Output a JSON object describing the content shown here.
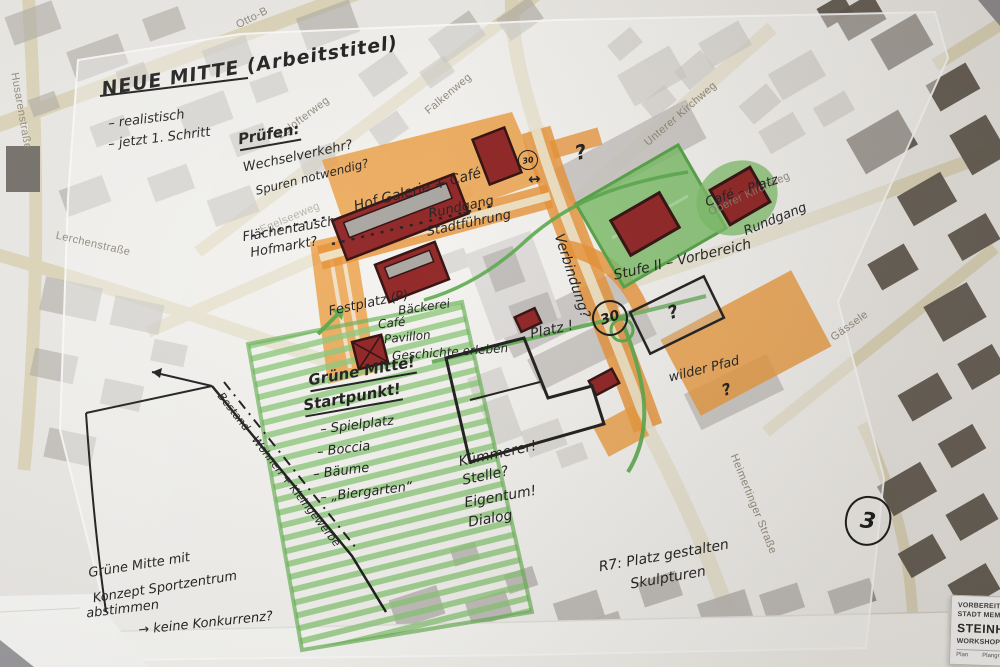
{
  "streets": [
    {
      "name": "Husarenstraße"
    },
    {
      "name": "Otto-B"
    },
    {
      "name": "Falkenweg"
    },
    {
      "name": "Eglofterweg"
    },
    {
      "name": "Egelseeweg"
    },
    {
      "name": "Lerchenstraße"
    },
    {
      "name": "Unterer Kirchweg"
    },
    {
      "name": "Oberer Kirchweg"
    },
    {
      "name": "Gässele"
    },
    {
      "name": "Heimertinger Straße"
    }
  ],
  "notes": {
    "title": "NEUE MITTE (Arbeitstitel)",
    "goal1": "– realistisch",
    "goal2": "– jetzt 1. Schritt",
    "pruefen_head": "Prüfen:",
    "pruefen_a": "Wechselverkehr?",
    "pruefen_b": "Spuren notwendig?",
    "flaechentausch_a": "Flächentausch",
    "flaechentausch_b": "Hofmarkt?",
    "hof_galerie": "Hof Galerie + Café",
    "rundgang_a": "Rundgang",
    "rundgang_b": "Stadtführung",
    "festplatz": "Festplatz (P)",
    "baeckerei": "Bäckerei",
    "cafe_a": "Café",
    "cafe_b": "Pavillon",
    "cafe_c": "Geschichte erleben",
    "gruene_mitte_head": "Grüne Mitte!",
    "startpunkt": "Startpunkt!",
    "item_spielplatz": "– Spielplatz",
    "item_boccia": "– Boccia",
    "item_baeume": "– Bäume",
    "item_biergarten": "– „Biergarten“",
    "kuemmerer": "Kümmerer!",
    "stelle": "Stelle?",
    "eigentum": "Eigentum!",
    "dialog": "Dialog",
    "verbindung": "Verbindung?",
    "platz": "Platz !",
    "wilder_pfad": "wilder Pfad",
    "stufe2": "Stufe II – Vorbereich",
    "cafe_platz": "Café – Platz",
    "rundgang_c": "Rundgang",
    "bestand": "Bestand · Wohnen + Kleingewerbe",
    "abstimmen_a": "Grüne Mitte mit",
    "abstimmen_b": "Konzept Sportzentrum",
    "abstimmen_c": "abstimmen",
    "abstimmen_d": "→ keine Konkurrenz?",
    "r7_a": "R7: Platz gestalten",
    "r7_b": "Skulpturen"
  },
  "markers": {
    "zone30_small": "30",
    "zone30_large": "30",
    "area3": "3",
    "question": "?",
    "arrow": "↔"
  },
  "title_block": {
    "line1": "VORBEREITEN",
    "line2": "STADT MEMMIN",
    "line3": "STEINHEIM",
    "line4": "WORKSHOP OR",
    "plan_label": "Plan",
    "plan_label2": "Plangr"
  },
  "colors": {
    "marker_orange": "#E8912E",
    "marker_green": "#7CBF66",
    "building_red": "#8E2020",
    "road_tan": "#DDD5B6",
    "building_gray": "#ACA8A2",
    "building_dark": "#5D554C",
    "ink_black": "#1A1A1A",
    "paper": "#EDEBE7"
  }
}
